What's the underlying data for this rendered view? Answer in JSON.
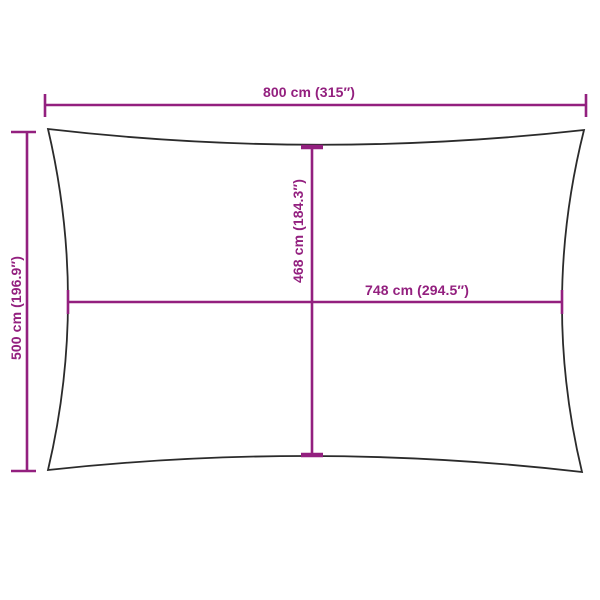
{
  "diagram": {
    "dimensions": {
      "total_width": {
        "label": "800 cm (315″)"
      },
      "total_height": {
        "label": "500 cm (196.9″)"
      },
      "inner_height": {
        "label": "468 cm (184.3″)"
      },
      "inner_width": {
        "label": "748 cm (294.5″)"
      }
    },
    "colors": {
      "dimension_accent": "#93207F",
      "outline": "#2B2B2B",
      "background": "#FFFFFF"
    }
  }
}
